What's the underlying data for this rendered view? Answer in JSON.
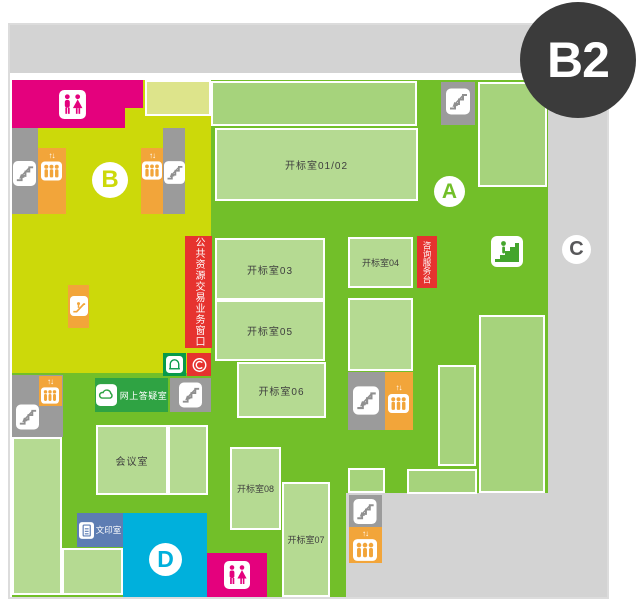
{
  "floor_badge": "B2",
  "zone_markers": {
    "a": "A",
    "b": "B",
    "c": "C",
    "d": "D"
  },
  "rooms": {
    "bid_room_0102": "开标室01/02",
    "bid_room_03": "开标室03",
    "bid_room_04": "开标室04",
    "bid_room_05": "开标室05",
    "bid_room_06": "开标室06",
    "bid_room_07": "开标室07",
    "bid_room_08": "开标室08",
    "meeting_room": "会议室",
    "print_room": "文印室",
    "online_qa_room": "网上答疑室"
  },
  "signs": {
    "service_window": "公共资源交易业务窗口",
    "info_desk": "咨询服务台"
  },
  "elevator_arrows": "↑↓",
  "icons": {
    "restroom": "male-female-figures",
    "stairs": "staircase-with-arrow",
    "elevator": "three-people-with-updown-arrows",
    "escalator": "diagonal-steps",
    "stairs_up": "person-climbing-stairs",
    "online_qa": "cloud",
    "print": "document",
    "kiosk": "arch-terminal",
    "cert": "circled-c"
  },
  "colors": {
    "field_green": "#72bf29",
    "room_green": "#b5da92",
    "room_green_alt": "#a6d37c",
    "lime": "#ccd90a",
    "pale_lime": "#dde48b",
    "magenta": "#e4017d",
    "orange": "#f2a53a",
    "red": "#e6332f",
    "qa_green": "#2fa343",
    "kiosk_green": "#089a4a",
    "print_blue": "#5d7db3",
    "zone_d_cyan": "#00b0dc",
    "gray_light": "#d3d3d3",
    "gray_dark": "#9b9b9b",
    "badge_dark": "#3b3b3b"
  }
}
